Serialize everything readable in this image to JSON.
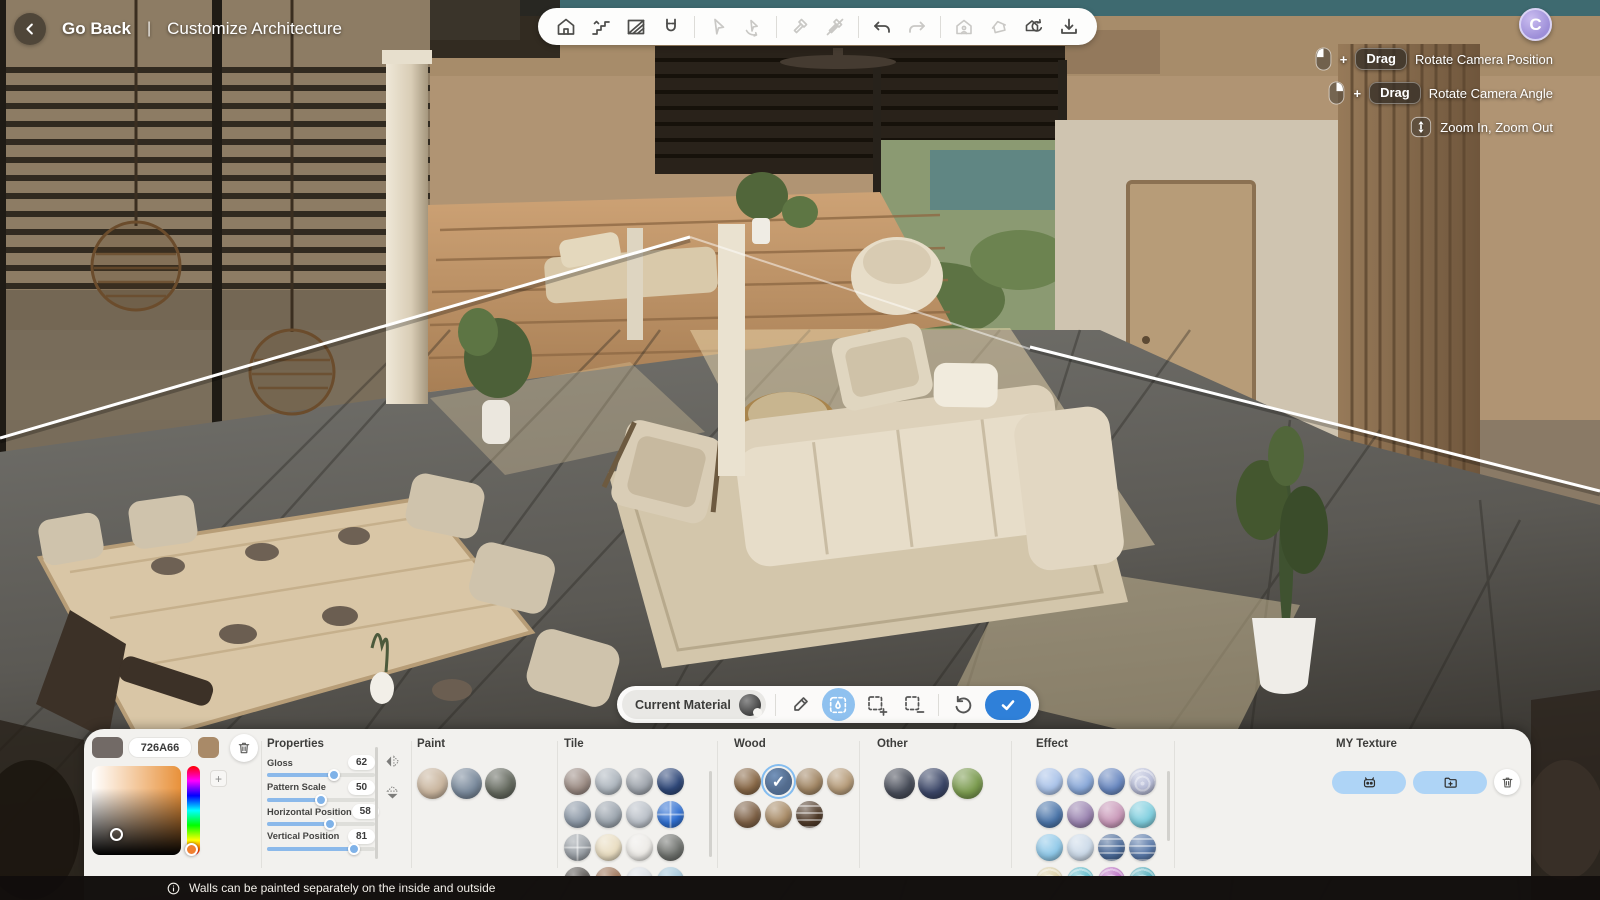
{
  "header": {
    "back_label": "Go Back",
    "separator": "|",
    "title": "Customize Architecture"
  },
  "logo": {
    "letter": "C"
  },
  "toolbar": {
    "tools": [
      "home",
      "stairs",
      "wall-paint",
      "snap-magnet",
      "select-cursor",
      "rotate-object",
      "demolish",
      "demolish-off",
      "undo",
      "redo",
      "house-walkthrough",
      "roof-toggle",
      "reset-view",
      "save"
    ]
  },
  "hints": {
    "rows": [
      {
        "mouse": "left-button",
        "plus": "+",
        "key": "Drag",
        "label": "Rotate Camera Position"
      },
      {
        "mouse": "right-button",
        "plus": "+",
        "key": "Drag",
        "label": "Rotate Camera Angle"
      },
      {
        "mouse": "scroll-wheel",
        "label": "Zoom In, Zoom Out"
      }
    ]
  },
  "material_bar": {
    "current_label": "Current Material",
    "tools": [
      "material-dropper",
      "paint-area",
      "selection-add",
      "selection-remove",
      "reset",
      "confirm"
    ]
  },
  "panel": {
    "color_picker": {
      "hex": "726A66",
      "current_color": "#726A66",
      "secondary_color": "#A98A68",
      "plus_label": "+"
    },
    "properties": {
      "title": "Properties",
      "sliders": [
        {
          "label": "Gloss",
          "value": 62
        },
        {
          "label": "Pattern Scale",
          "value": 50
        },
        {
          "label": "Horizontal Position",
          "value": 58
        },
        {
          "label": "Vertical Position",
          "value": 81
        }
      ]
    },
    "sections": [
      {
        "title": "Paint",
        "swatches": [
          {
            "color": "#c8b49d"
          },
          {
            "color": "#79899b"
          },
          {
            "color": "#64695e"
          }
        ]
      },
      {
        "title": "Tile",
        "swatches": [
          {
            "color": "#9c8c84"
          },
          {
            "color": "#aeb6be"
          },
          {
            "color": "#9fa5ad"
          },
          {
            "color": "#30497a"
          },
          {
            "color": "#8d99a7"
          },
          {
            "color": "#9ca5ae"
          },
          {
            "color": "#bac0c8"
          },
          {
            "color": "#3070d2",
            "pattern": "cross"
          },
          {
            "color": "#9aa0a6",
            "pattern": "cross"
          },
          {
            "color": "#e9ddc1"
          },
          {
            "color": "#edebe7"
          },
          {
            "color": "#70736f"
          },
          {
            "color": "#56524f"
          },
          {
            "color": "#9b7053"
          },
          {
            "color": "#dadfe4"
          },
          {
            "color": "#a2c6da"
          }
        ]
      },
      {
        "title": "Wood",
        "swatches": [
          {
            "color": "#8a6a49"
          },
          {
            "color": "#6e5138",
            "selected": true
          },
          {
            "color": "#a28765"
          },
          {
            "color": "#b69c7a"
          },
          {
            "color": "#7e6146"
          },
          {
            "color": "#a98c68"
          },
          {
            "color": "#503b29",
            "pattern": "stripes"
          }
        ]
      },
      {
        "title": "Other",
        "swatches": [
          {
            "color": "#484d59"
          },
          {
            "color": "#3b4667"
          },
          {
            "color": "#7b9b4f"
          }
        ]
      },
      {
        "title": "Effect",
        "swatches": [
          {
            "color": "#aac3e9"
          },
          {
            "color": "#8aa9d9"
          },
          {
            "color": "#6a89c1"
          },
          {
            "color": "#b9bed9",
            "pattern": "swirl"
          },
          {
            "color": "#4c76aa"
          },
          {
            "color": "#9b85b1"
          },
          {
            "color": "#c999b9"
          },
          {
            "color": "#80cfdf"
          },
          {
            "color": "#90c9e9"
          },
          {
            "color": "#ccdae9"
          },
          {
            "color": "#4a6a99",
            "pattern": "stripes"
          },
          {
            "color": "#5979a9",
            "pattern": "stripes"
          },
          {
            "color": "#d9cca1",
            "pattern": "swirl"
          },
          {
            "color": "#59b9c9",
            "pattern": "swirl"
          },
          {
            "color": "#b969c1",
            "pattern": "swirl"
          },
          {
            "color": "#49a9b9",
            "pattern": "swirl"
          }
        ]
      }
    ],
    "my_texture": {
      "title": "MY Texture",
      "buttons": [
        "ai-texture",
        "import-texture",
        "delete-texture"
      ]
    }
  },
  "footer": {
    "note": "Walls can be painted separately on the inside and outside"
  },
  "colors": {
    "accent_blue": "#2f80d9",
    "tool_active_blue": "#8fc1ef",
    "pill_blue": "#aed4f6",
    "slider_blue": "#8bb9ea"
  }
}
